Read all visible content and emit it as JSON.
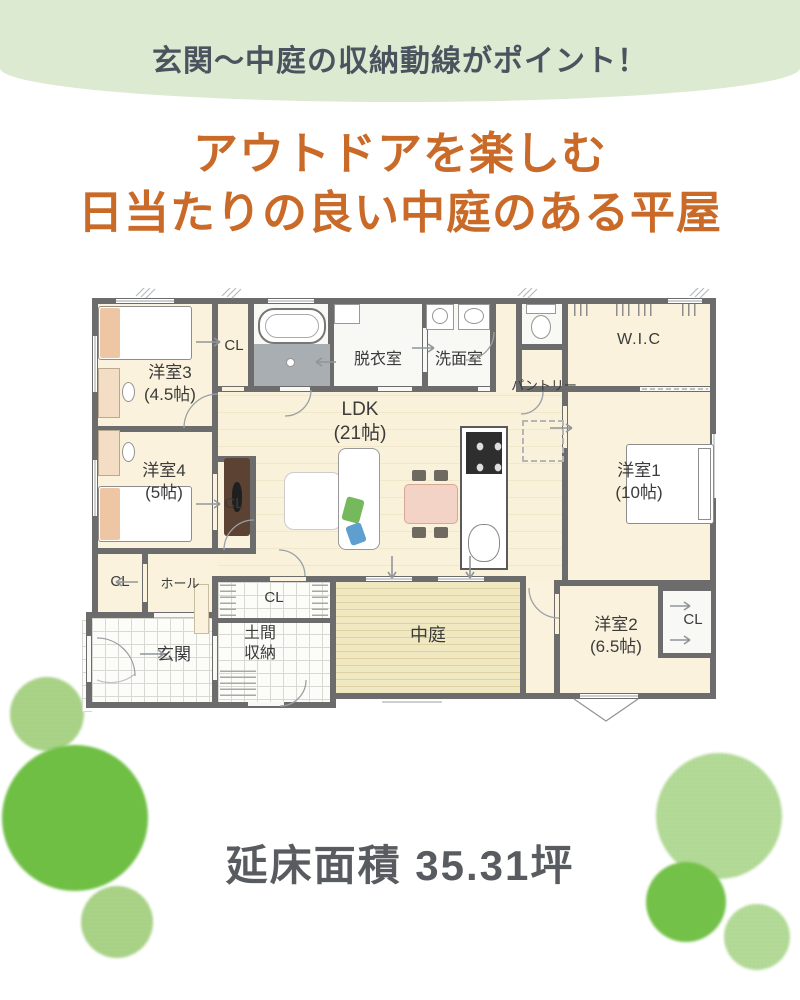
{
  "banner": {
    "text": "玄関〜中庭の収納動線がポイント！",
    "bg_color": "#dcead2",
    "text_color": "#4b545e"
  },
  "title": {
    "line1": "アウトドアを楽しむ",
    "line2": "日当たりの良い中庭のある平屋",
    "color": "#c96a28"
  },
  "footer": {
    "area_text": "延床面積 35.31坪"
  },
  "plan": {
    "labels": {
      "yoshitsu3": {
        "name": "洋室3",
        "size": "(4.5帖)"
      },
      "cl3": "CL",
      "datsuishitsu": "脱衣室",
      "senmenshitsu": "洗面室",
      "pantry": "パントリー",
      "wic": "W.I.C",
      "ldk": {
        "name": "LDK",
        "size": "(21帖)"
      },
      "yoshitsu4": {
        "name": "洋室4",
        "size": "(5帖)"
      },
      "cl4": "CL",
      "yoshitsu1": {
        "name": "洋室1",
        "size": "(10帖)"
      },
      "hall_cl": "CL",
      "hall": "ホール",
      "genkan": "玄関",
      "doma_cl": "CL",
      "doma": {
        "line1": "土間",
        "line2": "収納"
      },
      "nakaniwa": "中庭",
      "yoshitsu2": {
        "name": "洋室2",
        "size": "(6.5帖)"
      },
      "cl2": "CL"
    },
    "colors": {
      "wall": "#6c6c6c",
      "room_cream": "#faf2dc",
      "deck_yellow": "#f0e8c0",
      "accent_green_solid": "#6fbf45",
      "accent_green_light": "#aed58c"
    }
  }
}
